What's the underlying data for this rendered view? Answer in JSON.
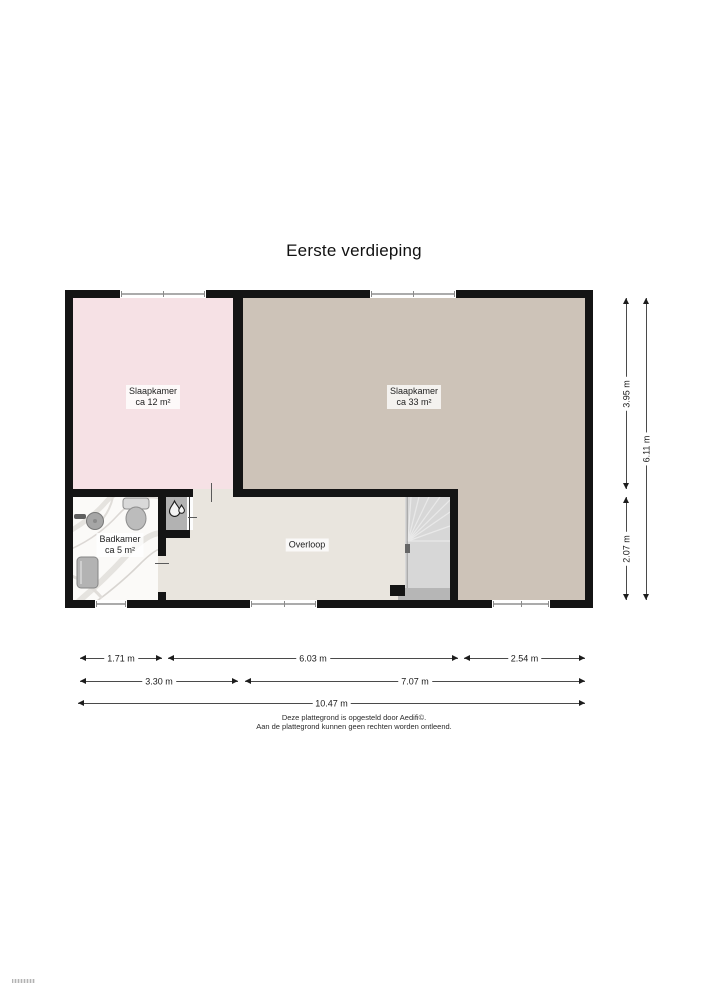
{
  "title": "Eerste verdieping",
  "plan": {
    "rooms": {
      "bedroom_left": {
        "name": "Slaapkamer",
        "area": "ca 12 m²"
      },
      "bedroom_right": {
        "name": "Slaapkamer",
        "area": "ca 33 m²"
      },
      "bathroom": {
        "name": "Badkamer",
        "area": "ca 5 m²"
      },
      "landing": {
        "name": "Overloop"
      }
    },
    "fixtures": [
      "toilet",
      "sink",
      "bathroom-cabinet",
      "winder-staircase",
      "water-drop-closet"
    ],
    "colors": {
      "wall": "#141414",
      "bedroom_left_floor": "#f6e1e5",
      "bedroom_right_floor": "#cdc3b8",
      "landing_floor": "#e9e5de",
      "bathroom_floor": "#fbfaf8",
      "stairs_floor": "#d7d7d7",
      "closet_floor": "#b2b2b2"
    }
  },
  "dimensions": {
    "right_inner_top": "3.95 m",
    "right_inner_bottom": "2.07 m",
    "right_outer": "6.11 m",
    "bottom_row1": [
      "1.71 m",
      "6.03 m",
      "2.54 m"
    ],
    "bottom_row2": [
      "3.30 m",
      "7.07 m"
    ],
    "bottom_total": "10.47 m"
  },
  "footer": {
    "line1": "Deze plattegrond is opgesteld door Aedifi©.",
    "line2": "Aan de plattegrond kunnen geen rechten worden ontleend."
  }
}
